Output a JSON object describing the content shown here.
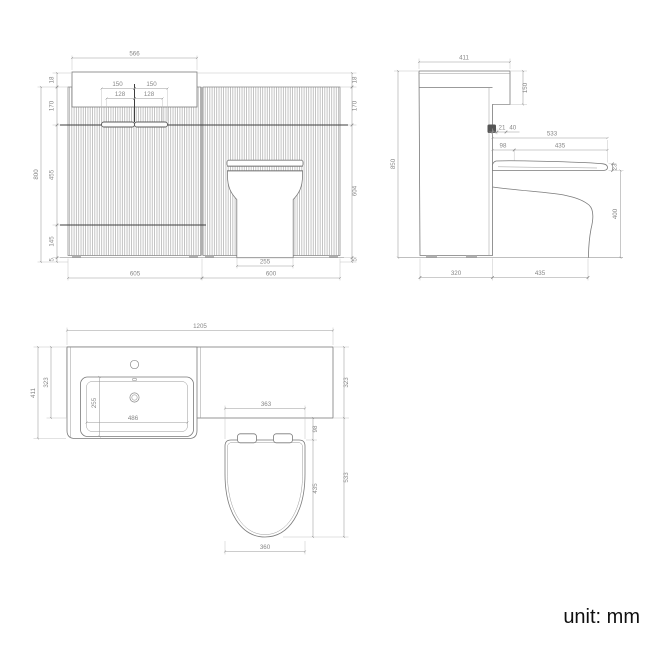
{
  "front": {
    "top_width": "566",
    "handle_left": "150",
    "handle_right": "150",
    "handle_inner_left": "128",
    "handle_inner_right": "128",
    "top_thickness_left": "18",
    "top_thickness_right": "18",
    "upper_height_left": "170",
    "upper_height_right": "170",
    "overall_height": "800",
    "drawer_height": "455",
    "base_height": "145",
    "plinth_left": "5",
    "plinth_right": "5",
    "wc_unit_height": "604",
    "pan_width": "255",
    "vanity_width": "605",
    "wc_unit_width": "600"
  },
  "side": {
    "overall_depth": "411",
    "worktop_return": "150",
    "overall_height": "850",
    "handle_offset": "21",
    "handle_depth": "40",
    "wc_total_depth": "533",
    "seat_setback": "98",
    "seat_depth": "435",
    "seat_thickness": "23",
    "pan_height": "400",
    "cabinet_depth": "320",
    "pan_projection": "435"
  },
  "plan": {
    "overall_width": "1205",
    "overall_depth": "411",
    "worktop_depth_left": "323",
    "worktop_depth_right": "323",
    "basin_depth": "255",
    "basin_width": "486",
    "wc_recess_width": "363",
    "seat_setback": "98",
    "seat_depth": "435",
    "wc_total_depth": "533",
    "seat_width": "360"
  },
  "footer": {
    "unit_label": "unit: mm"
  }
}
